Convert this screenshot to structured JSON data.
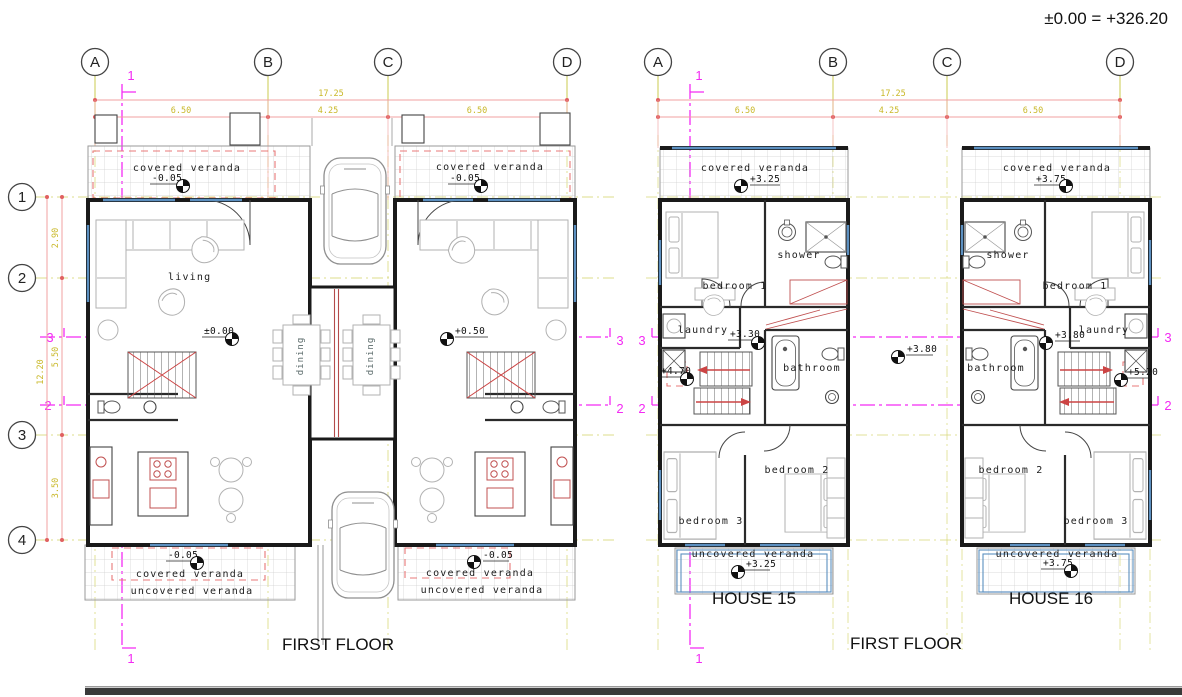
{
  "datum_note": "±0.00 = +326.20",
  "grid": {
    "cols": [
      "A",
      "B",
      "C",
      "D"
    ],
    "rows": [
      "1",
      "2",
      "3",
      "4"
    ]
  },
  "dimensions": {
    "total_width": "17.25",
    "col_spans": [
      "6.50",
      "4.25",
      "6.50"
    ],
    "total_height": "12.20",
    "row_spans": [
      "2.90",
      "5.50",
      "3.50"
    ]
  },
  "section_marks": {
    "one": "1",
    "two": "2",
    "three": "3"
  },
  "left_plan": {
    "title": "FIRST FLOOR",
    "covered_veranda": "covered veranda",
    "uncovered_veranda": "uncovered veranda",
    "living": "living",
    "dining": "dining",
    "levels": {
      "veranda": "-0.05",
      "unit_left": "±0.00",
      "unit_right": "+0.50"
    }
  },
  "right_plan": {
    "title": "FIRST FLOOR",
    "house_left": "HOUSE 15",
    "house_right": "HOUSE 16",
    "covered_veranda": "covered veranda",
    "uncovered_veranda": "uncovered veranda",
    "rooms": {
      "bedroom1": "bedroom 1",
      "bedroom2": "bedroom 2",
      "bedroom3": "bedroom 3",
      "shower": "shower",
      "laundry": "laundry",
      "bathroom": "bathroom"
    },
    "levels": {
      "h15_veranda": "+3.25",
      "h15_hall": "+3.30",
      "h15_stair": "+4.70",
      "h15_uncovered": "+3.25",
      "h16_veranda": "+3.75",
      "h16_hall": "+3.80",
      "h16_stair": "+5.20",
      "h16_uncovered": "+3.75",
      "between": "+3.80"
    }
  },
  "colors": {
    "dimension_line": "#f0a0a0",
    "dimension_text": "#c9b829",
    "section_line": "#f32bf3",
    "grid_line": "#c6c63c",
    "wall": "#1a1a1a",
    "overhang_dash": "#e87878",
    "window_glazing": "#5b8fc0",
    "furniture": "#b2b2b2"
  }
}
